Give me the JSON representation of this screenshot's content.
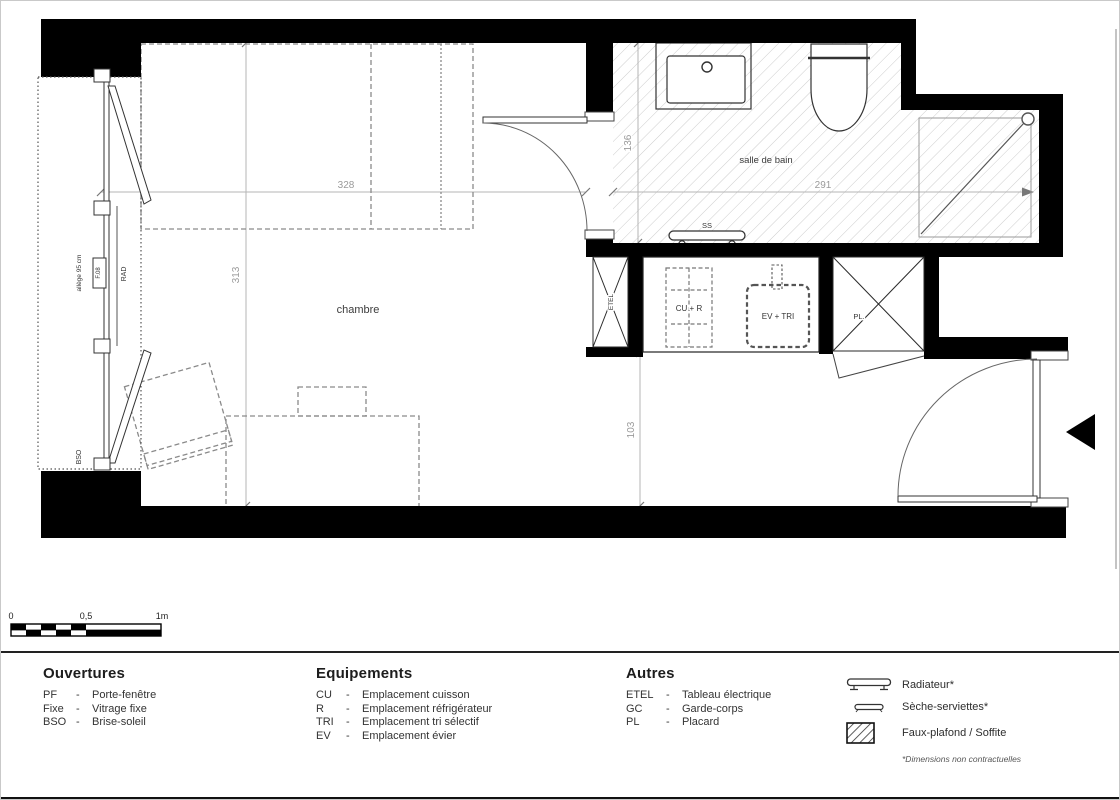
{
  "plan": {
    "rooms": {
      "bedroom": "chambre",
      "bathroom": "salle de bain"
    },
    "dims": {
      "bedroom_width": "328",
      "bathroom_width": "291",
      "bedroom_depth": "313",
      "bathroom_depth": "136",
      "hall_depth": "103"
    },
    "labels": {
      "towel_rail": "SS",
      "electrical": "ETEL",
      "closet": "PL.",
      "cooking_fridge": "CU + R",
      "sink_sorting": "EV + TRI",
      "window_ref": "F.08",
      "radiator": "RAD",
      "sill": "allège 95 cm",
      "sunbreak": "BSO"
    }
  },
  "scalebar": {
    "t0": "0",
    "t05": "0,5",
    "t1": "1m"
  },
  "legend": {
    "dash": "-",
    "ouvertures": {
      "title": "Ouvertures",
      "items": [
        {
          "abbr": "PF",
          "label": "Porte-fenêtre"
        },
        {
          "abbr": "Fixe",
          "label": "Vitrage fixe"
        },
        {
          "abbr": "BSO",
          "label": "Brise-soleil"
        }
      ]
    },
    "equipements": {
      "title": "Equipements",
      "items": [
        {
          "abbr": "CU",
          "label": "Emplacement cuisson"
        },
        {
          "abbr": "R",
          "label": "Emplacement réfrigérateur"
        },
        {
          "abbr": "TRI",
          "label": "Emplacement tri sélectif"
        },
        {
          "abbr": "EV",
          "label": "Emplacement évier"
        }
      ]
    },
    "autres": {
      "title": "Autres",
      "items": [
        {
          "abbr": "ETEL",
          "label": "Tableau électrique"
        },
        {
          "abbr": "GC",
          "label": "Garde-corps"
        },
        {
          "abbr": "PL",
          "label": "Placard"
        }
      ]
    },
    "symbols": {
      "radiator": "Radiateur*",
      "towel_dryer": "Sèche-serviettes*",
      "soffit": "Faux-plafond / Soffite",
      "footnote": "*Dimensions non contractuelles"
    }
  }
}
